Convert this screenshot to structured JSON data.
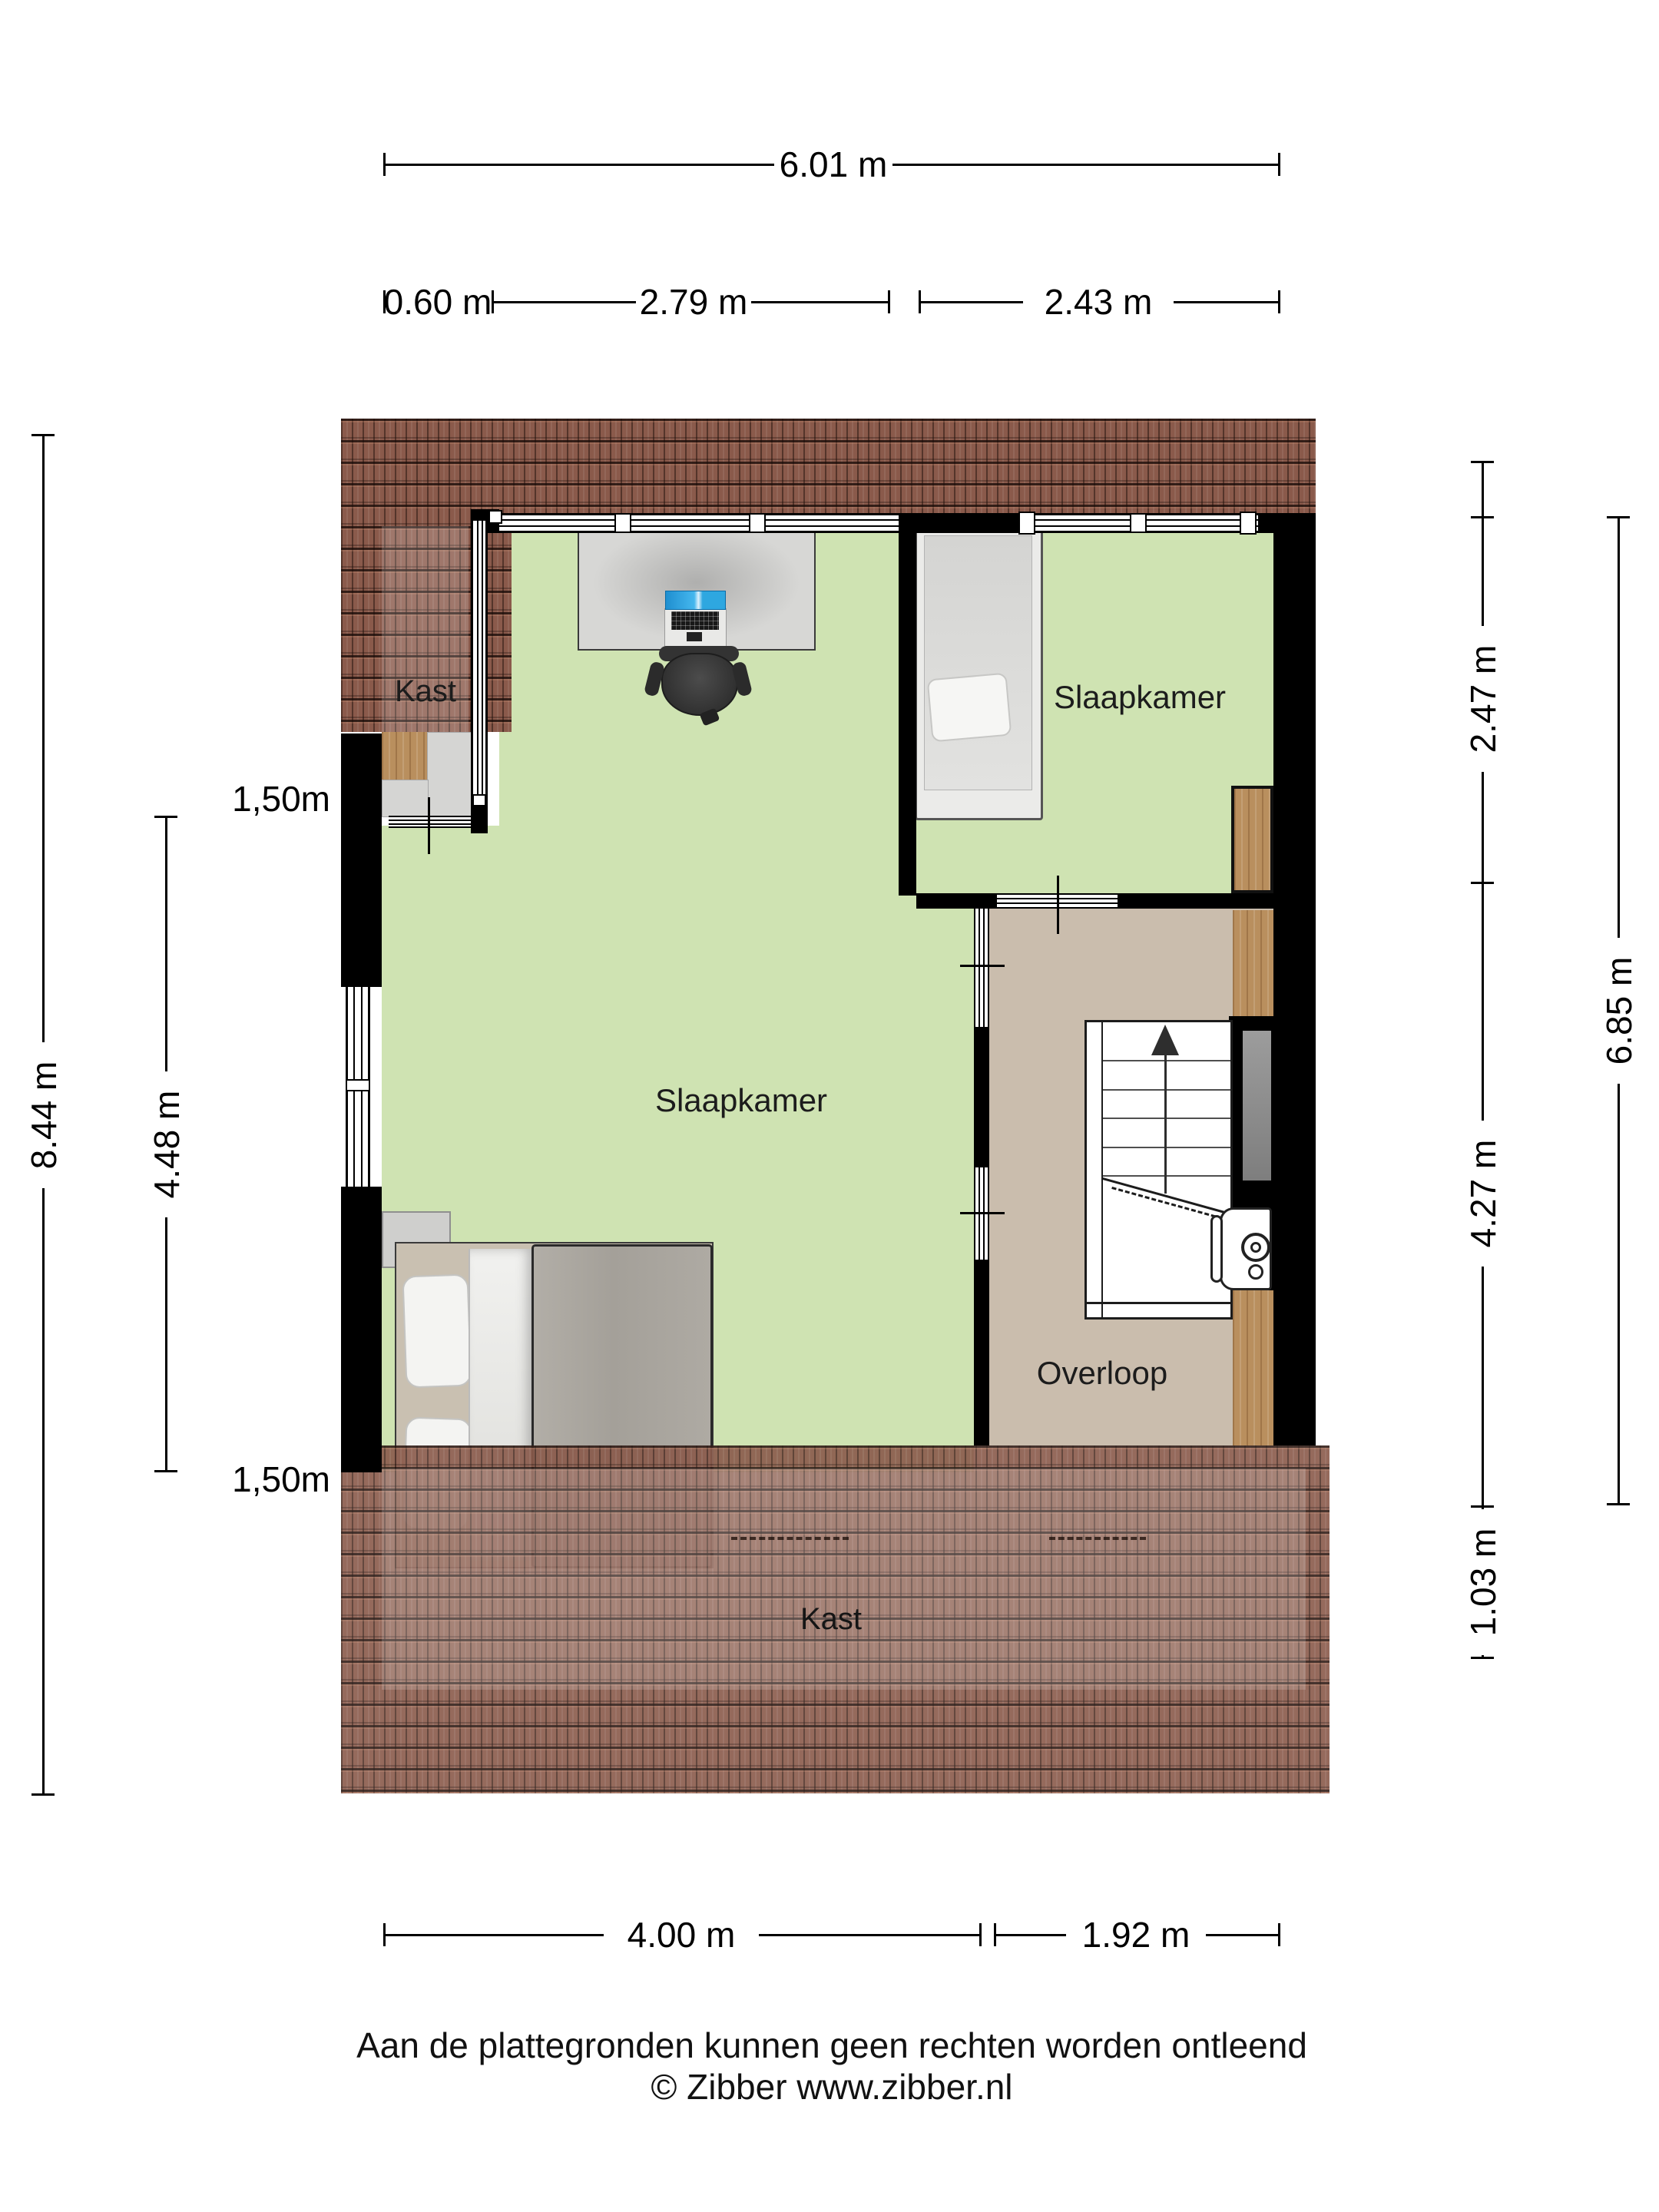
{
  "dimensions": {
    "top": "6.01 m",
    "top_row": [
      "0.60 m",
      "2.79 m",
      "2.43 m"
    ],
    "left_outer": "8.44 m",
    "left_inner": "4.48 m",
    "headroom_top": "1,50m",
    "headroom_bottom": "1,50m",
    "right_inner": [
      "2.47 m",
      "4.27 m",
      "1.03 m"
    ],
    "right_outer": "6.85 m",
    "bottom": [
      "4.00 m",
      "1.92 m"
    ]
  },
  "rooms": {
    "kast_top": "Kast",
    "slaapkamer_right": "Slaapkamer",
    "slaapkamer_main": "Slaapkamer",
    "overloop": "Overloop",
    "kast_bottom": "Kast"
  },
  "footer": {
    "disclaimer": "Aan de plattegronden kunnen geen rechten worden ontleend",
    "copyright": "© Zibber www.zibber.nl"
  },
  "colors": {
    "floor_bedroom": "#cfe3b2",
    "floor_landing": "#cabdad",
    "roof": "#8a5a4b",
    "wall": "#000000",
    "wood": "#b98f5e",
    "screen_accent": "#2ea7e0"
  }
}
